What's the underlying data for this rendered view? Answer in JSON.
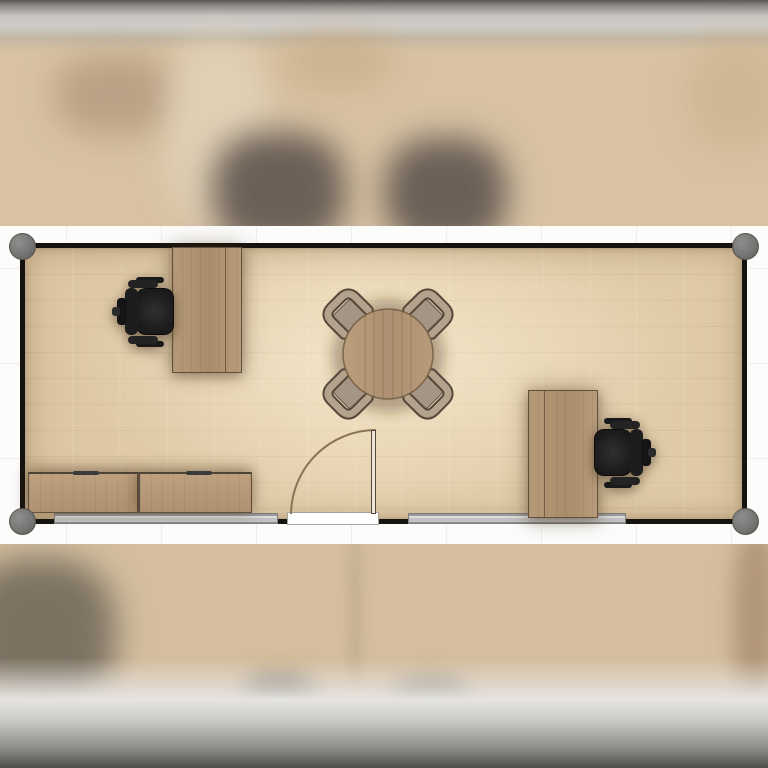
{
  "meta": {
    "view": "floor-plan-top-view",
    "description": "Blurred planner viewport focused on one rectangular office module; neighbouring modules above and below are out of focus",
    "visible_text": "none"
  },
  "colors": {
    "background_band": "#fcfcfb",
    "grid_line": "#efeeec",
    "wall": "#16130f",
    "corner_post": "#7b7a78",
    "floor_light": "#e6d2b0",
    "floor_dark": "#dcc5a1",
    "desk_wood": "#b0936f",
    "cabinet_wood": "#b59a78",
    "table_wood": "#b49774",
    "office_chair_black": "#1d1d1d",
    "side_chair_frame_tan": "#b3a28c",
    "side_chair_seat": "#a59585",
    "window_strip": "#c9c9c9",
    "door_threshold": "#ffffff",
    "door_swing_arc": "#8a7356",
    "blur_surround_beige": "#d8c2a3",
    "blur_band_gray": "#8f8d89"
  },
  "room": {
    "shape": "rectangle",
    "corner_posts": 4,
    "windows_bottom_wall": 2,
    "door": {
      "position": "bottom-wall-center",
      "swing": "inward, hinge right, open 90 degrees"
    }
  },
  "furniture": [
    {
      "id": "desk-top-left",
      "type": "desk",
      "orientation": "vertical, against top wall"
    },
    {
      "id": "office-chair-left",
      "type": "swivel chair",
      "color": "black",
      "facing": "right toward desk"
    },
    {
      "id": "meeting-table",
      "type": "round table",
      "seats": 4
    },
    {
      "id": "meeting-chairs",
      "type": "side chairs",
      "count": 4,
      "placement": "diagonal around table"
    },
    {
      "id": "desk-right",
      "type": "desk",
      "orientation": "vertical, against bottom wall"
    },
    {
      "id": "office-chair-right",
      "type": "swivel chair",
      "color": "black",
      "facing": "left toward desk"
    },
    {
      "id": "cabinet-left",
      "type": "low sideboard",
      "placement": "bottom-left wall"
    },
    {
      "id": "cabinet-right",
      "type": "low sideboard",
      "placement": "bottom-left wall, adjacent"
    }
  ]
}
